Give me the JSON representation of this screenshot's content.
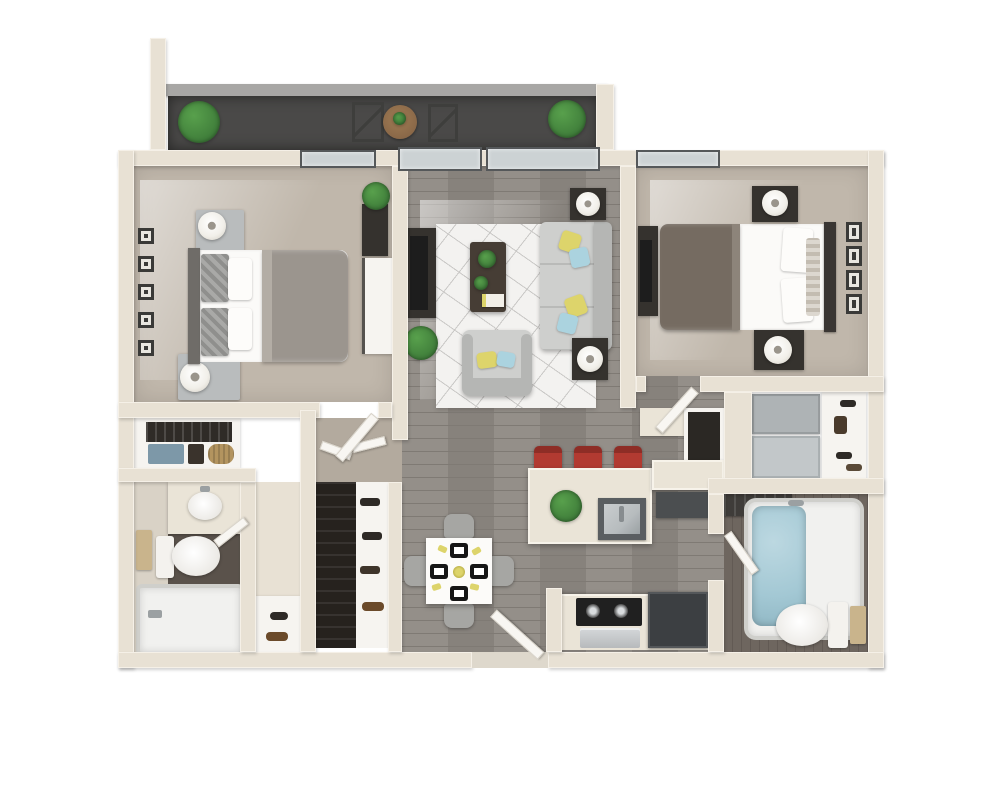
{
  "meta": {
    "type": "3d-floor-plan-render",
    "description": "Top-down 3D rendering of a two-bedroom, two-bathroom apartment with balcony, open living/dining/kitchen area; no text labels are present in the image"
  },
  "palette": {
    "wall": "#e8e1d4",
    "wallEdge": "#f5f0e7",
    "rail": "#a8a7a5",
    "balcony": "#4a4948",
    "floorWood": "#8e8983",
    "woodLine": "#7f7a74",
    "carpet": "#c0b7ab",
    "hall": "#b3aa9e",
    "bath1Floor": "#d9d2c6",
    "bath1Dark": "#5a524b",
    "bath2Floor": "#6e665f",
    "bath2Line": "#625a54",
    "rug": "#f3f2f0",
    "rugLine": "#c9c8c6",
    "sofa": "#cecfcd",
    "sofaEdge": "#b5b6b4",
    "pillowYellow": "#ddd46b",
    "pillowBlue": "#abd3df",
    "darkFurn": "#35322e",
    "black": "#1d1d1d",
    "whiteFurn": "#f6f4f0",
    "steel": "#b7bcbe",
    "steelDark": "#5a5e61",
    "counter": "#eae4d7",
    "stoolRed": "#b23a31",
    "stoolRedDark": "#8e2d26",
    "fridge": "#3c3f42",
    "water": "#a3c8d4",
    "plant": "#58a04c",
    "plantDark": "#3f7d3a",
    "woodTable": "#8a6848",
    "towelTan": "#c9b48c",
    "towelBlue": "#7d98a8",
    "basketTan": "#b3945f",
    "grayChair": "#a6a6a3",
    "duvet1": "#9b958e",
    "duvet2": "#756b61",
    "lamp": "#f1efe9",
    "bedWhite": "#fbfaf8",
    "glass": "#ccd2d4",
    "frameDark": "#55585a",
    "doorWhite": "#f8f6f2",
    "appliance": "#aeb3b5"
  },
  "rooms": [
    {
      "id": "balcony",
      "furniture": [
        "potted-plant-left",
        "potted-plant-right",
        "round-bistro-table",
        "wire-chairs",
        "concrete-railing"
      ]
    },
    {
      "id": "bedroom-1",
      "furniture": [
        "queen-bed-gray-duvet",
        "nightstand-with-lamp-top",
        "nightstand-with-lamp-bottom",
        "five-wall-frames",
        "white-dresser",
        "tv-unit",
        "potted-plant",
        "window"
      ]
    },
    {
      "id": "living-room",
      "furniture": [
        "three-seat-sofa",
        "armchair",
        "coffee-table-with-plants-and-book",
        "geometric-area-rug",
        "tv-console",
        "end-table-lamp-top",
        "end-table-lamp-bottom",
        "potted-plant",
        "two-sliding-glass-doors"
      ]
    },
    {
      "id": "bedroom-2",
      "furniture": [
        "queen-bed-dark-duvet",
        "nightstand-with-lamp-top",
        "nightstand-with-lamp-bottom",
        "four-wall-frames",
        "media-console",
        "window"
      ]
    },
    {
      "id": "dining-area",
      "furniture": [
        "square-white-table",
        "four-gray-chairs",
        "four-place-settings",
        "yellow-centerpiece"
      ]
    },
    {
      "id": "kitchen",
      "furniture": [
        "island-with-stainless-sink",
        "three-red-bar-stools",
        "island-plant",
        "dark-appliance-cabinet",
        "black-cooktop",
        "stainless-oven",
        "dark-refrigerator",
        "entry-door"
      ]
    },
    {
      "id": "bathroom-1",
      "furniture": [
        "vanity-with-oval-sink",
        "toilet",
        "walk-in-shower-tub",
        "towel-bar",
        "door"
      ]
    },
    {
      "id": "bathroom-2",
      "furniture": [
        "soaking-tub-filled-with-water",
        "toilet",
        "tan-towel",
        "dark-shower-shelf",
        "door"
      ]
    },
    {
      "id": "linen-closet",
      "furniture": [
        "hanging-rod",
        "blue-towels",
        "tan-basket"
      ]
    },
    {
      "id": "wardrobe-closet",
      "furniture": [
        "hanging-clothes",
        "white-shoe-shelves",
        "open-doors"
      ]
    },
    {
      "id": "hallway-closets",
      "furniture": [
        "coat-niche",
        "gray-sliding-doors",
        "shoe-and-bag-shelf",
        "beige-cabinet"
      ]
    },
    {
      "id": "entry-bench",
      "furniture": [
        "white-bench",
        "brown-shoes"
      ]
    }
  ]
}
